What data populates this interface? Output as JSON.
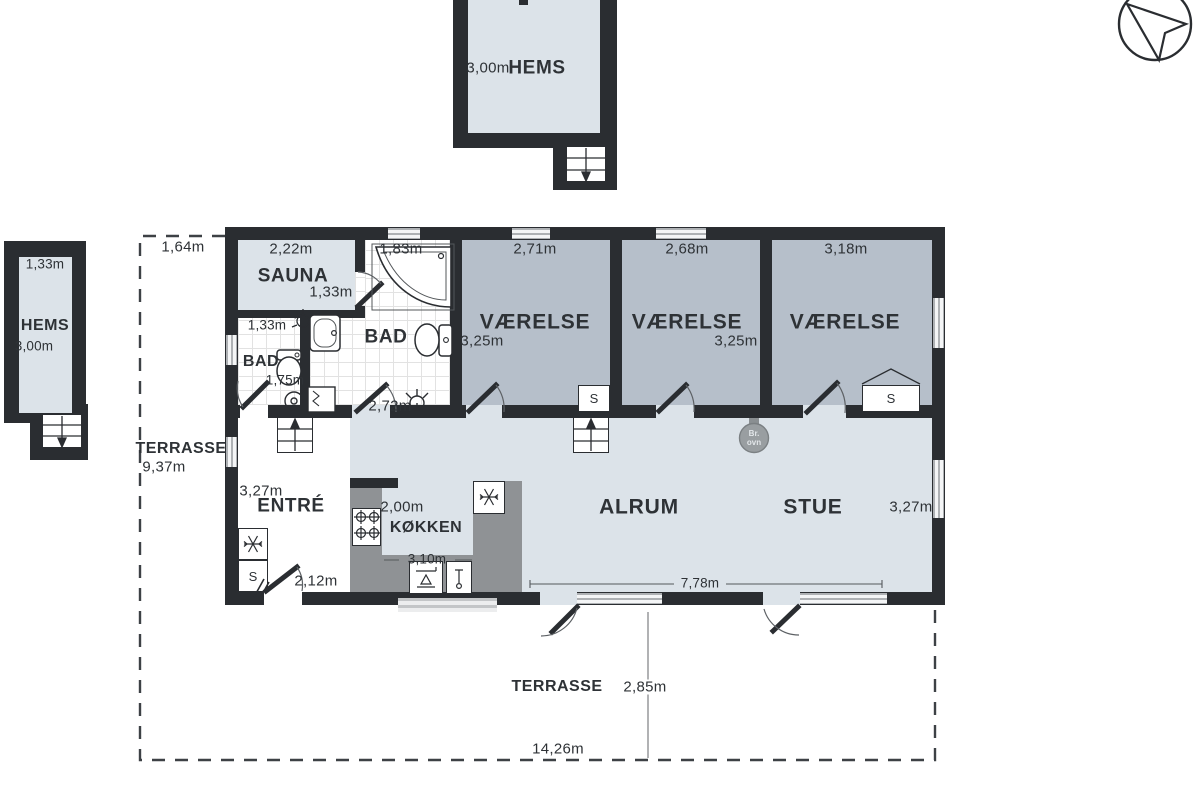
{
  "title": "floor plan",
  "colors": {
    "wall": "#2a2d31",
    "floor_light": "#dce3e9",
    "floor_bedroom": "#b6bfca",
    "counter_gray": "#8f9295",
    "text": "#2e3236"
  },
  "detached_hems_top": {
    "dim": "3,00m",
    "label": "HEMS"
  },
  "detached_hems_left": {
    "width_dim": "1,33m",
    "label": "HEMS",
    "height_dim": "3,00m"
  },
  "terrace_left": {
    "offset_dim": "1,64m",
    "label": "TERRASSE",
    "length_dim": "9,37m"
  },
  "terrace_bottom": {
    "label": "TERRASSE",
    "depth_dim": "2,85m",
    "width_dim": "14,26m"
  },
  "rooms": {
    "sauna": {
      "label": "SAUNA",
      "width_dim": "2,22m",
      "height_dim": "1,33m"
    },
    "bad_small": {
      "label": "BAD",
      "width_dim": "1,33m",
      "height_dim": "1,75m"
    },
    "bad_large": {
      "label": "BAD",
      "width_dim": "1,83m",
      "door_dim": "2,72m"
    },
    "bedroom_1": {
      "label": "VÆRELSE",
      "width_dim": "2,71m",
      "height_dim": "3,25m",
      "closet": "S"
    },
    "bedroom_2": {
      "label": "VÆRELSE",
      "width_dim": "2,68m",
      "height_dim": "3,25m"
    },
    "bedroom_3": {
      "label": "VÆRELSE",
      "width_dim": "3,18m",
      "closet": "S"
    },
    "entre": {
      "label": "ENTRÉ",
      "height_dim": "3,27m",
      "door_dim": "2,12m",
      "closet": "S"
    },
    "kokken": {
      "label": "KØKKEN",
      "counter_dim": "2,00m",
      "width_dim": "3,10m"
    },
    "alrum": {
      "label": "ALRUM",
      "width_dim": "7,78m"
    },
    "stue": {
      "label": "STUE",
      "height_dim": "3,27m",
      "stove_label_1": "Br.",
      "stove_label_2": "ovn"
    }
  }
}
